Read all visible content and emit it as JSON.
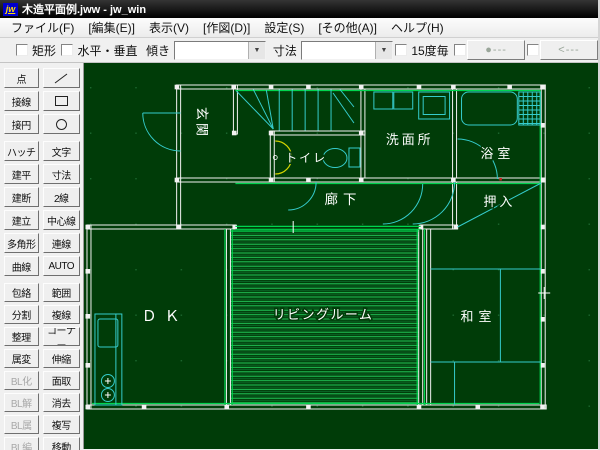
{
  "window": {
    "title": "木造平面例.jww - jw_win",
    "icon_text": "jw"
  },
  "menu": {
    "items": [
      "ファイル(F)",
      "[編集(E)]",
      "表示(V)",
      "[作図(D)]",
      "設定(S)",
      "[その他(A)]",
      "ヘルプ(H)"
    ]
  },
  "toolbar": {
    "rect_checkbox_label": "矩形",
    "hv_checkbox_label": "水平・垂直",
    "incline_label": "傾き",
    "incline_value": "",
    "dimension_label": "寸法",
    "dimension_value": "",
    "deg15_checkbox_label": "15度毎",
    "dot_button_label": "●---",
    "arrow_button_label": "<---"
  },
  "sidebar": {
    "left_column": [
      "点",
      "接線",
      "接円",
      "ハッチ",
      "建平",
      "建断",
      "建立",
      "多角形",
      "曲線",
      "包絡",
      "分割",
      "整理",
      "属変",
      "BL化",
      "BL解",
      "BL属",
      "BL編"
    ],
    "right_column": [
      "／",
      "□",
      "○",
      "文字",
      "寸法",
      "2線",
      "中心線",
      "連線",
      "AUTO",
      "範囲",
      "複線",
      "コーナー",
      "伸縮",
      "面取",
      "消去",
      "複写",
      "移動"
    ],
    "icon_buttons": [
      "line-icon",
      "rectangle-icon",
      "circle-icon"
    ],
    "disabled_buttons": [
      "BL化",
      "BL解",
      "BL属",
      "BL編"
    ]
  },
  "plan": {
    "room_labels": [
      "玄関",
      "トイレ",
      "洗面所",
      "浴室",
      "廊下",
      "押入",
      "ＤＫ",
      "リビングルーム",
      "和室"
    ],
    "fixtures": [
      "stairs",
      "toilet",
      "toilet-tank",
      "washbasin",
      "washing-machine",
      "bathtub",
      "tile-grid",
      "closet-diagonal",
      "tatami-lines",
      "kitchen-counter",
      "kitchen-sink",
      "stove-burners",
      "door-arcs"
    ],
    "colors": {
      "canvas_background": "#003c08",
      "walls": "#f2f2f2",
      "fixtures_cyan": "#35cccc",
      "accent_green": "#00d44e",
      "hatch_green": "#22c95a",
      "door_arc_yellow": "#d4d400",
      "label_text": "#ffffff",
      "grid_dots": "#1d6830"
    }
  }
}
